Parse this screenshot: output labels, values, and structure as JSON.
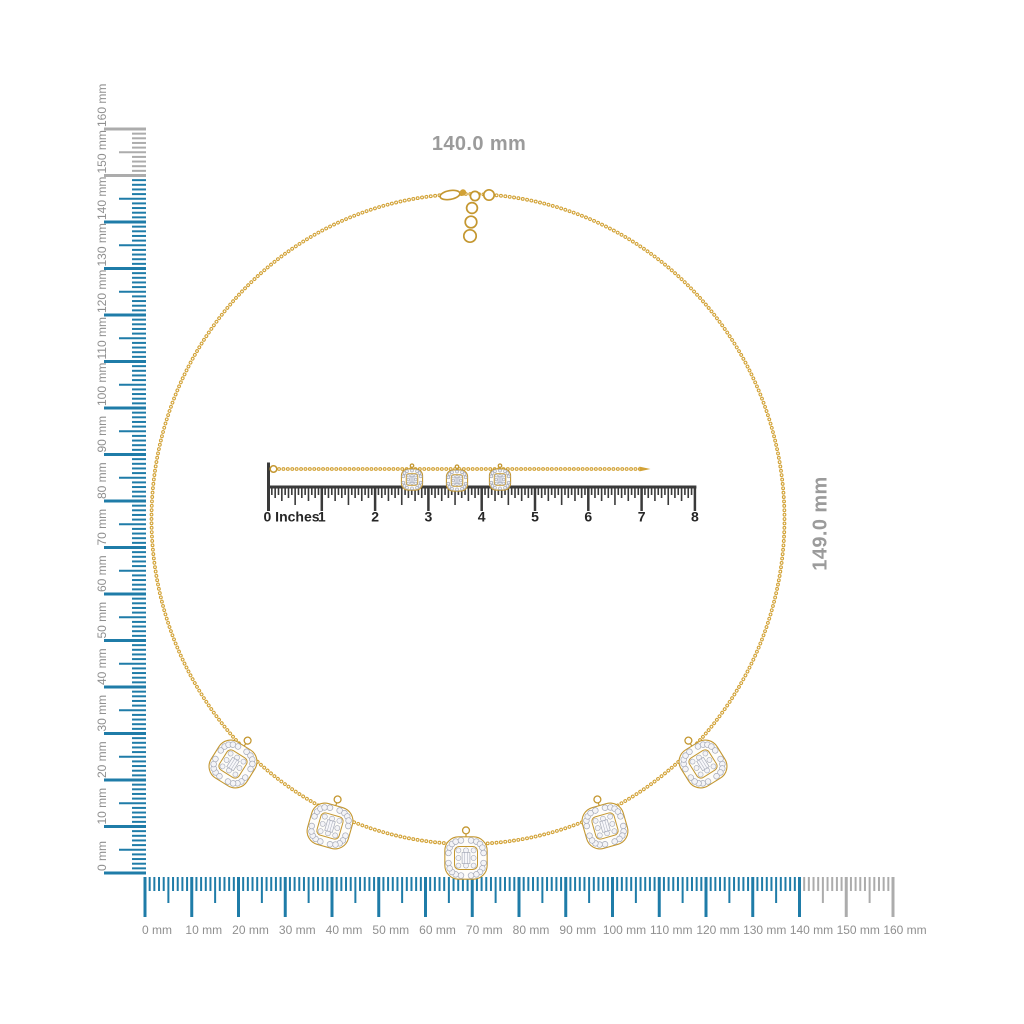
{
  "page": {
    "title": "Necklace with measurement rulers",
    "background": "#FFFFFF"
  },
  "dimension_labels": {
    "width": "140.0 mm",
    "height": "149.0 mm"
  },
  "rulers": {
    "mm_labels": [
      "0 mm",
      "10 mm",
      "20 mm",
      "30 mm",
      "40 mm",
      "50 mm",
      "60 mm",
      "70 mm",
      "80 mm",
      "90 mm",
      "100 mm",
      "110 mm",
      "120 mm",
      "130 mm",
      "140 mm",
      "150 mm",
      "160 mm"
    ],
    "left_mm": {
      "unit": "mm",
      "min": 0,
      "max": 160,
      "minor_step": 1,
      "medium_step": 5,
      "major_step": 10,
      "highlight_limit": 149
    },
    "bottom_mm": {
      "unit": "mm",
      "min": 0,
      "max": 160,
      "minor_step": 1,
      "medium_step": 5,
      "major_step": 10,
      "highlight_limit": 140
    },
    "inches": {
      "unit": "inches",
      "min": 0,
      "max": 8,
      "divisions_per_inch": 16,
      "labels": [
        "0 Inches",
        "1",
        "2",
        "3",
        "4",
        "5",
        "6",
        "7",
        "8"
      ]
    }
  },
  "necklace": {
    "kind": "gold cable-chain necklace with cushion diamond-halo charms",
    "charms_on_circle": 5,
    "charms_on_straight_chain": 3
  },
  "colors": {
    "ruler_active": "#1F7CA8",
    "ruler_inactive": "#ACACAC",
    "ruler_label": "#8F8F8F",
    "inch_tick": "#3A3A3A",
    "inch_label": "#262626",
    "dimension_label": "#9B9B9B",
    "gold": "#D2A236",
    "gold_dark": "#C49730",
    "gold_light": "#F0D78E",
    "diamond_fill": "#F4F4F7",
    "diamond_stroke": "#A6AAB8",
    "background": "#FFFFFF"
  }
}
